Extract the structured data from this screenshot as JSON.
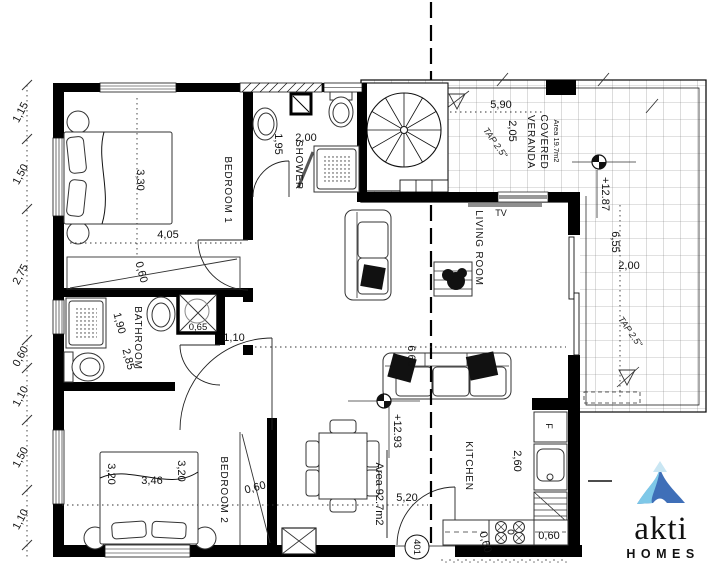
{
  "plan": {
    "rooms": {
      "bedroom1": {
        "label": "BEDROOM 1",
        "dim_width": "3,30",
        "dim_length": "4,05",
        "wardrobe_depth": "0,60"
      },
      "shower_room": {
        "label": "SHOWER",
        "dim_width": "2,00",
        "dim_depth": "1,95"
      },
      "bathroom": {
        "label": "BATHROOM",
        "dim_width": "1,90",
        "dim_length": "2,85",
        "shaft_width": "0,65",
        "opening_width": "1,10"
      },
      "bedroom2": {
        "label": "BEDROOM 2",
        "dim_bed_head": "3,20",
        "dim_bed_width": "3,46",
        "dim_bed_foot": "3,20",
        "wardrobe_depth": "0,60"
      },
      "living_room": {
        "label": "LIVING ROOM",
        "tv_label": "TV",
        "dim_length": "6,60",
        "dim_width": "5,20"
      },
      "kitchen": {
        "label": "KITCHEN",
        "dim_width": "2,60",
        "counter_depth_a": "0,60",
        "counter_depth_b": "0,60",
        "fridge_label": "F"
      },
      "veranda": {
        "label_line1": "COVERED",
        "label_line2": "VERANDA",
        "area": "Area 19.7m2",
        "dim_width": "5,90",
        "dim_depth": "2,05",
        "dim_length": "6,55",
        "dim_side_width": "2,00",
        "slope_a": "TAP 2.5\"",
        "slope_b": "TAP 2.5\""
      }
    },
    "annotations": {
      "total_area": "Area 92.7m2",
      "level_interior": "+12.93",
      "level_veranda": "+12.87",
      "door_number": "401"
    },
    "left_dimension_chain": [
      "1,15",
      "1,50",
      "2,75",
      "0,60",
      "1,10",
      "1,50",
      "1,10"
    ]
  },
  "logo": {
    "brand": "akti",
    "word": "HOMES",
    "colors": {
      "brand": "#a9b5d6",
      "word": "#a5d8ec",
      "icon_light": "#7ec8e8",
      "icon_dark": "#3f6fb8",
      "icon_top": "#c9e6f3"
    }
  }
}
